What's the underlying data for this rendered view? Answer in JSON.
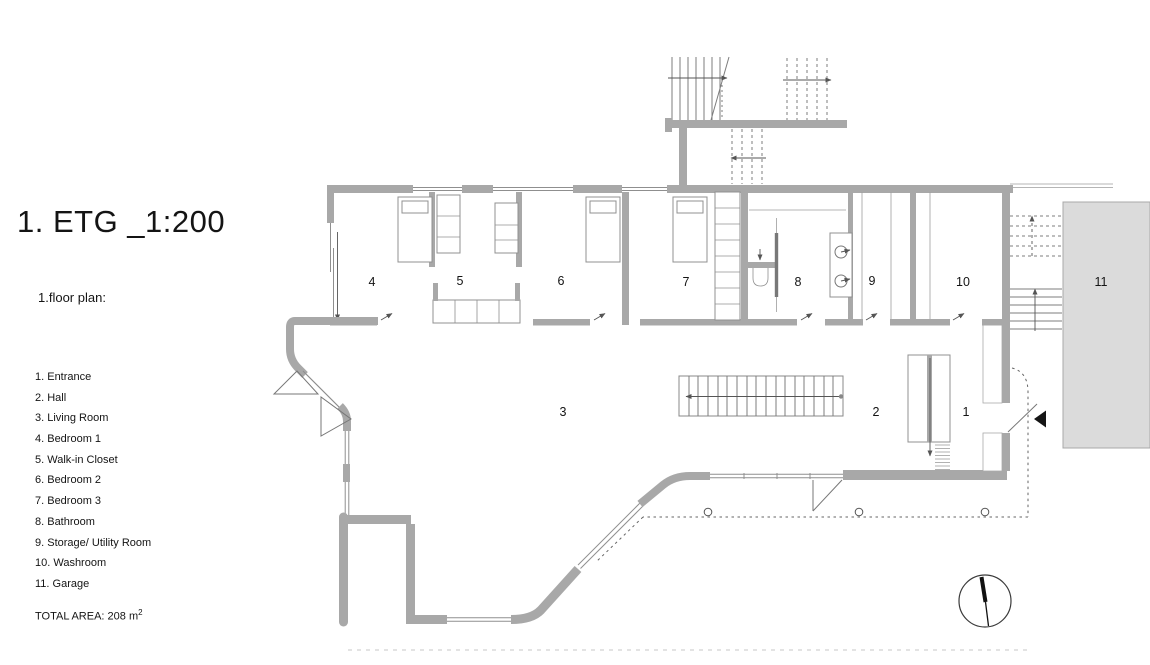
{
  "title": "1. ETG _1:200",
  "subtitle": "1.floor plan:",
  "legend": {
    "items": [
      "1. Entrance",
      "2. Hall",
      "3. Living Room",
      "4. Bedroom 1",
      "5. Walk-in Closet",
      "6. Bedroom 2",
      "7. Bedroom 3",
      "8. Bathroom",
      "9. Storage/ Utility Room",
      "10. Washroom",
      "11. Garage"
    ]
  },
  "total_area": {
    "text": "TOTAL AREA: 208 m",
    "sup": "2"
  },
  "rooms": {
    "n1": "1",
    "n2": "2",
    "n3": "3",
    "n4": "4",
    "n5": "5",
    "n6": "6",
    "n7": "7",
    "n8": "8",
    "n9": "9",
    "n10": "10",
    "n11": "11"
  },
  "colors": {
    "wall": "#a8a8a8",
    "garage_fill": "#dbdbdb",
    "garage_border": "#a8a8a8",
    "ink": "#141414",
    "thin_line": "#8f8f8f",
    "dash": "#666666"
  }
}
